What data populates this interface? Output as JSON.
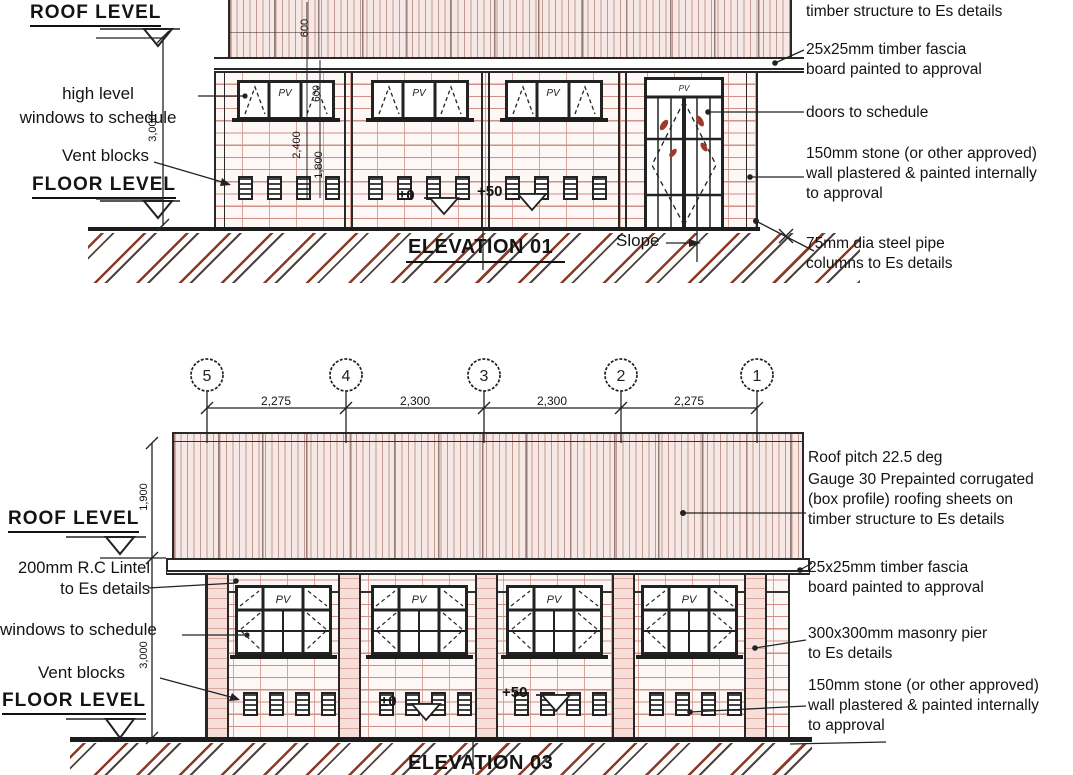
{
  "e1": {
    "title": "ELEVATION 01",
    "roof_level": "ROOF LEVEL",
    "floor_level": "FLOOR LEVEL",
    "high_level_line1": "high level",
    "high_level_line2": "windows to schedule",
    "vent_blocks": "Vent blocks",
    "slope": "Slope",
    "level_zero": "±0",
    "level_plus50": "+50",
    "pv": "PV",
    "dims": {
      "wall_height": "3,000",
      "roof_edge": "600",
      "window_height": "600",
      "window_head": "2,400",
      "window_sill": "1,800"
    },
    "ann": [
      "timber structure to Es details",
      "25x25mm timber fascia",
      "board painted to approval",
      "doors to schedule",
      "150mm stone (or other approved)",
      "wall plastered & painted internally",
      "to approval",
      "75mm dia steel pipe",
      "columns to Es details"
    ]
  },
  "e3": {
    "title": "ELEVATION 03",
    "roof_level": "ROOF LEVEL",
    "floor_level": "FLOOR LEVEL",
    "lintel_line1": "200mm R.C Lintel",
    "lintel_line2": "to Es details",
    "windows_note": "windows to schedule",
    "vent_blocks": "Vent blocks",
    "level_zero": "±0",
    "level_plus50": "+50",
    "pv": "PV",
    "dims": {
      "roof_height": "1,900",
      "wall_height": "3,000"
    },
    "grid": {
      "bubbles": [
        "5",
        "4",
        "3",
        "2",
        "1"
      ],
      "spacings": [
        "2,275",
        "2,300",
        "2,300",
        "2,275"
      ]
    },
    "ann": [
      "Roof pitch 22.5 deg",
      "Gauge 30 Prepainted corrugated",
      "(box profile) roofing sheets on",
      "timber structure to Es details",
      "25x25mm timber fascia",
      "board painted to approval",
      "300x300mm masonry pier",
      "to Es details",
      "150mm stone (or other approved)",
      "wall plastered & painted internally",
      "to approval"
    ]
  },
  "colors": {
    "line": "#222222",
    "brick_joint": "#cf9186",
    "roof_fill": "#f6e9e5",
    "hatch_red": "#8c3a26",
    "glass_mark_red": "#9c3a2c"
  }
}
